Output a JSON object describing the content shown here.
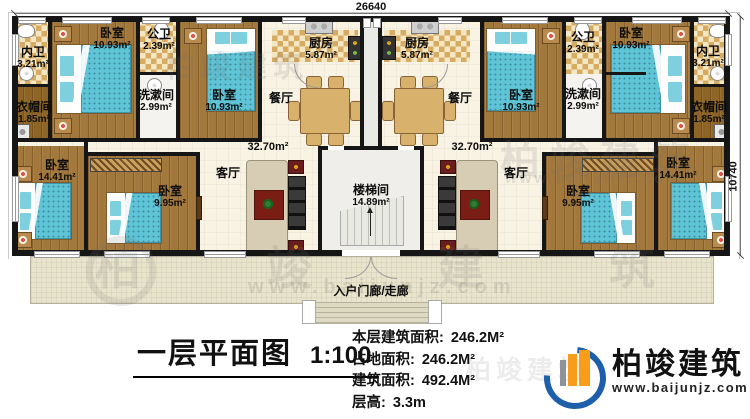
{
  "drawing": {
    "title": "一层平面图",
    "scale": "1:100"
  },
  "dimensions": {
    "top_width": "26640",
    "right_height": "10740"
  },
  "stats": {
    "floor_area_label": "本层建筑面积:",
    "floor_area_value": "246.2M²",
    "land_area_label": "占地面积:",
    "land_area_value": "246.2M²",
    "total_area_label": "建筑面积:",
    "total_area_value": "492.4M²",
    "height_label": "层高:",
    "height_value": "3.3m"
  },
  "brand": {
    "name": "柏竣建筑",
    "website": "www.baijunjz.com"
  },
  "watermark": {
    "name": "柏竣建筑",
    "website": "www.baijunjz.com"
  },
  "rooms": {
    "inner_bath_left": {
      "name": "内卫",
      "area": "3.21m²"
    },
    "bedroom_top_left_1": {
      "name": "卧室",
      "area": "10.93m²"
    },
    "public_bath_left": {
      "name": "公卫",
      "area": "2.39m²"
    },
    "wash_room_left": {
      "name": "洗漱间",
      "area": "2.99m²"
    },
    "bedroom_top_left_2": {
      "name": "卧室",
      "area": "10.93m²"
    },
    "cloak_room_left": {
      "name": "衣帽间",
      "area": "1.85m²"
    },
    "kitchen_left": {
      "name": "厨房",
      "area": "5.87m²"
    },
    "dining_left": {
      "name": "餐厅"
    },
    "living_left": {
      "name": "客厅",
      "area": "32.70m²"
    },
    "bedroom_bottom_left_1": {
      "name": "卧室",
      "area": "14.41m²"
    },
    "bedroom_bottom_left_2": {
      "name": "卧室",
      "area": "9.95m²"
    },
    "stairwell": {
      "name": "楼梯间",
      "area": "14.89m²"
    },
    "kitchen_right": {
      "name": "厨房",
      "area": "5.87m²"
    },
    "dining_right": {
      "name": "餐厅"
    },
    "living_right": {
      "name": "客厅",
      "area": "32.70m²"
    },
    "public_bath_right": {
      "name": "公卫",
      "area": "2.39m²"
    },
    "bedroom_top_right_1": {
      "name": "卧室",
      "area": "10.93m²"
    },
    "bedroom_top_right_2": {
      "name": "卧室",
      "area": "10.93m²"
    },
    "inner_bath_right": {
      "name": "内卫",
      "area": "3.21m²"
    },
    "wash_room_right": {
      "name": "洗漱间",
      "area": "2.99m²"
    },
    "cloak_room_right": {
      "name": "衣帽间",
      "area": "1.85m²"
    },
    "bedroom_bottom_right_1": {
      "name": "卧室",
      "area": "9.95m²"
    },
    "bedroom_bottom_right_2": {
      "name": "卧室",
      "area": "14.41m²"
    },
    "entrance": {
      "name": "入户门廊/走廊"
    }
  }
}
